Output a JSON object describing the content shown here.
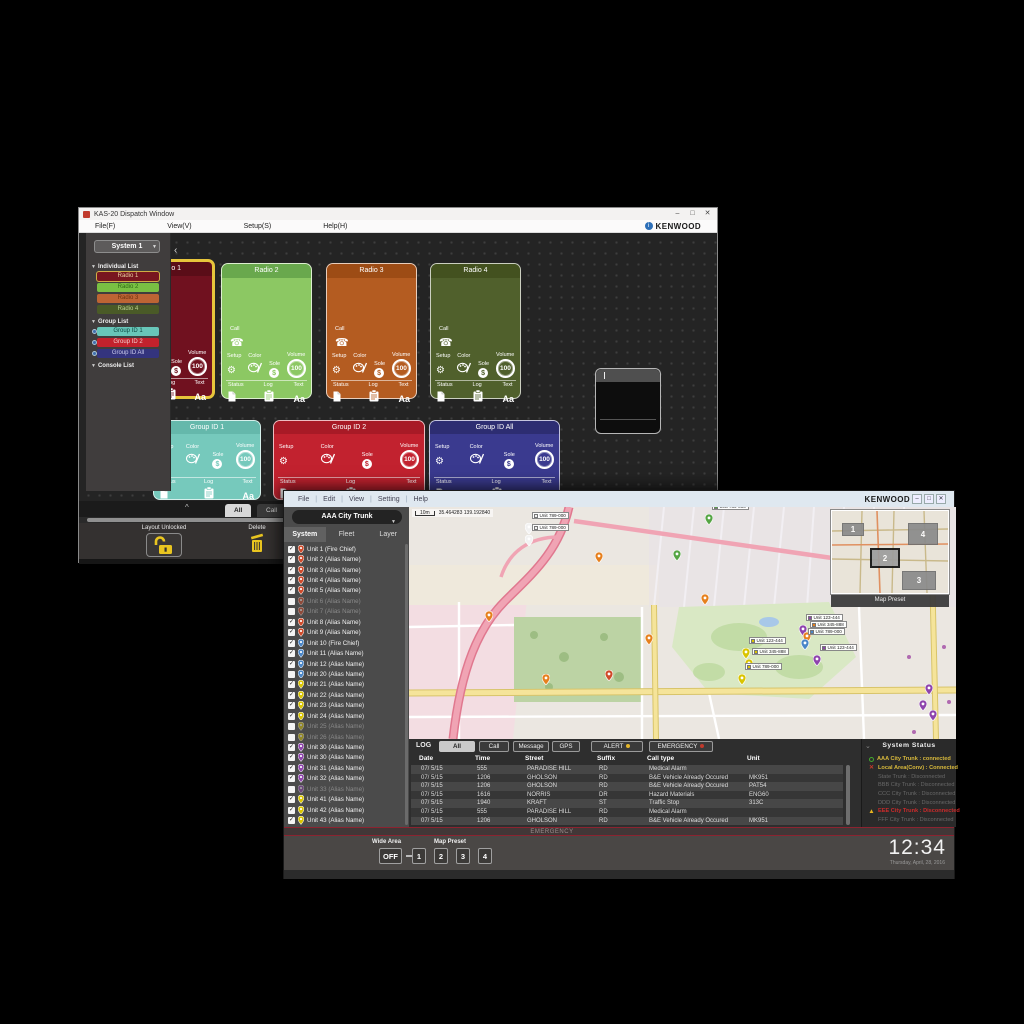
{
  "back_window": {
    "title": "KAS-20 Dispatch Window",
    "brand": "KENWOOD",
    "window_controls": [
      "–",
      "□",
      "✕"
    ],
    "menu_items": [
      "File(F)",
      "View(V)",
      "Setup(S)",
      "Help(H)"
    ],
    "system_selector": "System 1",
    "sidebar_sections": [
      {
        "label": "Individual List",
        "items": [
          {
            "label": "Radio 1",
            "color": "#78161f",
            "text_color": "#e8d0a0",
            "selected": true
          },
          {
            "label": "Radio 2",
            "color": "#79c043",
            "text_color": "#2e6b14"
          },
          {
            "label": "Radio 3",
            "color": "#bd6434",
            "text_color": "#6e3210"
          },
          {
            "label": "Radio 4",
            "color": "#4a5a27",
            "text_color": "#b9cf8e"
          }
        ]
      },
      {
        "label": "Group List",
        "items": [
          {
            "label": "Group ID 1",
            "color": "#68c6b9",
            "text_color": "#0e4a42",
            "group": true
          },
          {
            "label": "Group ID 2",
            "color": "#c2222d",
            "text_color": "#f2d0d0",
            "group": true
          },
          {
            "label": "Group ID All",
            "color": "#34347e",
            "text_color": "#ccccee",
            "group": true
          }
        ]
      },
      {
        "label": "Console List",
        "items": []
      }
    ],
    "tiles": [
      {
        "css": "tile-radio1",
        "name": "Radio 1",
        "type": "radio",
        "body": "#70111f",
        "header": "#5a0d18",
        "selected": true
      },
      {
        "css": "tile-radio2",
        "name": "Radio 2",
        "type": "radio",
        "body": "#8cc863",
        "header": "#69a84d"
      },
      {
        "css": "tile-radio3",
        "name": "Radio 3",
        "type": "radio",
        "body": "#b45c21",
        "header": "#9d4c15"
      },
      {
        "css": "tile-radio4",
        "name": "Radio 4",
        "type": "radio",
        "body": "#50602c",
        "header": "#43511f"
      },
      {
        "css": "tile-group1",
        "name": "Group ID 1",
        "type": "group",
        "body": "#76c9bc",
        "header": "#65b8ab"
      },
      {
        "css": "tile-group2",
        "name": "Group ID 2",
        "type": "group",
        "body": "#c2222f",
        "header": "#a81a26"
      },
      {
        "css": "tile-groupall",
        "name": "Group ID All",
        "type": "group",
        "body": "#3a3a8f",
        "header": "#2d2d72"
      },
      {
        "css": "tile-blank",
        "name": "",
        "type": "blank",
        "body": "#0d0d0d",
        "header": "#4f4f4f"
      }
    ],
    "tile_labels": {
      "call": "Call",
      "setup": "Setup",
      "color": "Color",
      "sole": "Sole",
      "volume": "Volume",
      "volume_value": "100",
      "status": "Status",
      "log": "Log",
      "text": "Text",
      "text_glyph": "Aa"
    },
    "dock": {
      "tabs": [
        {
          "label": "All",
          "selected": true
        },
        {
          "label": "Call",
          "selected": false
        }
      ],
      "layout_label": "Layout Unlocked",
      "delete_label": "Delete"
    }
  },
  "front_window": {
    "brand": "KENWOOD",
    "window_controls": [
      "–",
      "□",
      "✕"
    ],
    "menu_items": [
      "File",
      "Edit",
      "View",
      "Setting",
      "Help"
    ],
    "system_dropdown": "AAA City Trunk",
    "tabs": [
      {
        "label": "System",
        "selected": true
      },
      {
        "label": "Fleet",
        "selected": false
      },
      {
        "label": "Layer",
        "selected": false
      }
    ],
    "units": [
      {
        "label": "Unit 1 (Fire Chief)",
        "pin": "red",
        "checked": true,
        "dim": false
      },
      {
        "label": "Unit 2 (Alias Name)",
        "pin": "red",
        "checked": true,
        "dim": false
      },
      {
        "label": "Unit 3 (Alias Name)",
        "pin": "red",
        "checked": true,
        "dim": false
      },
      {
        "label": "Unit 4 (Alias Name)",
        "pin": "red",
        "checked": true,
        "dim": false
      },
      {
        "label": "Unit 5 (Alias Name)",
        "pin": "red",
        "checked": true,
        "dim": false
      },
      {
        "label": "Unit 6 (Alias Name)",
        "pin": "red",
        "checked": false,
        "dim": true
      },
      {
        "label": "Unit 7 (Alias Name)",
        "pin": "red",
        "checked": false,
        "dim": true
      },
      {
        "label": "Unit 8 (Alias Name)",
        "pin": "red",
        "checked": true,
        "dim": false
      },
      {
        "label": "Unit 9 (Alias Name)",
        "pin": "red",
        "checked": true,
        "dim": false
      },
      {
        "label": "Unit 10 (Fire Chief)",
        "pin": "blue",
        "checked": true,
        "dim": false
      },
      {
        "label": "Unit 11 (Alias Name)",
        "pin": "blue",
        "checked": true,
        "dim": false
      },
      {
        "label": "Unit 12 (Alias Name)",
        "pin": "blue",
        "checked": true,
        "dim": false
      },
      {
        "label": "Unit 20 (Alias Name)",
        "pin": "blue",
        "checked": false,
        "dim": false
      },
      {
        "label": "Unit 21 (Alias Name)",
        "pin": "yellow",
        "checked": true,
        "dim": false
      },
      {
        "label": "Unit 22 (Alias Name)",
        "pin": "yellow",
        "checked": true,
        "dim": false
      },
      {
        "label": "Unit 23 (Alias Name)",
        "pin": "yellow",
        "checked": true,
        "dim": false
      },
      {
        "label": "Unit 24 (Alias Name)",
        "pin": "yellow",
        "checked": true,
        "dim": false
      },
      {
        "label": "Unit 25 (Alias Name)",
        "pin": "yellow",
        "checked": false,
        "dim": true
      },
      {
        "label": "Unit 26 (Alias Name)",
        "pin": "yellow",
        "checked": false,
        "dim": true
      },
      {
        "label": "Unit 30 (Alias Name)",
        "pin": "purple",
        "checked": true,
        "dim": false
      },
      {
        "label": "Unit 30 (Alias Name)",
        "pin": "purple",
        "checked": true,
        "dim": false
      },
      {
        "label": "Unit 31 (Alias Name)",
        "pin": "purple",
        "checked": true,
        "dim": false
      },
      {
        "label": "Unit 32 (Alias Name)",
        "pin": "purple",
        "checked": true,
        "dim": false
      },
      {
        "label": "Unit 33 (Alias Name)",
        "pin": "purple",
        "checked": false,
        "dim": true
      },
      {
        "label": "Unit 41 (Alias Name)",
        "pin": "yellow",
        "checked": true,
        "dim": false
      },
      {
        "label": "Unit 42 (Alias Name)",
        "pin": "yellow",
        "checked": true,
        "dim": false
      },
      {
        "label": "Unit 43 (Alias Name)",
        "pin": "yellow",
        "checked": true,
        "dim": false
      }
    ],
    "map": {
      "scale_label": "10m",
      "coordinates": "35.464283   139.192840",
      "pin_colors": {
        "red": "#cf4a2a",
        "blue": "#4a86c8",
        "yellow": "#d9c400",
        "purple": "#8e44ad",
        "orange": "#e6801e",
        "green": "#55a544",
        "white": "#f2f2f2"
      },
      "markers": [
        {
          "x": 120,
          "y": 25,
          "color": "white",
          "label": "Unit 789-000"
        },
        {
          "x": 120,
          "y": 37,
          "color": "white",
          "label": "Unit 789-000"
        },
        {
          "x": 300,
          "y": 16,
          "color": "green",
          "label": "Unit 789-000"
        },
        {
          "x": 268,
          "y": 52,
          "color": "green"
        },
        {
          "x": 80,
          "y": 113,
          "color": "orange"
        },
        {
          "x": 137,
          "y": 176,
          "color": "orange"
        },
        {
          "x": 200,
          "y": 172,
          "color": "red"
        },
        {
          "x": 240,
          "y": 136,
          "color": "orange"
        },
        {
          "x": 296,
          "y": 96,
          "color": "orange"
        },
        {
          "x": 190,
          "y": 54,
          "color": "orange"
        },
        {
          "x": 337,
          "y": 150,
          "color": "yellow",
          "label": "Unit 123-444"
        },
        {
          "x": 340,
          "y": 161,
          "color": "yellow",
          "label": "Unit 345-888"
        },
        {
          "x": 333,
          "y": 176,
          "color": "yellow",
          "label": "Unit 789-000"
        },
        {
          "x": 394,
          "y": 127,
          "color": "purple",
          "label": "Unit 123-444"
        },
        {
          "x": 398,
          "y": 134,
          "color": "orange",
          "label": "Unit 345-888"
        },
        {
          "x": 396,
          "y": 141,
          "color": "blue",
          "label": "Unit 789-000"
        },
        {
          "x": 408,
          "y": 157,
          "color": "purple",
          "label": "Unit 123-444"
        },
        {
          "x": 520,
          "y": 186,
          "color": "purple"
        },
        {
          "x": 514,
          "y": 202,
          "color": "purple"
        },
        {
          "x": 524,
          "y": 212,
          "color": "purple"
        }
      ],
      "preset_overlay": {
        "label": "Map Preset",
        "items": [
          {
            "n": "1",
            "active": false
          },
          {
            "n": "2",
            "active": true
          },
          {
            "n": "3",
            "active": false
          },
          {
            "n": "4",
            "active": false
          }
        ]
      }
    },
    "log_panel": {
      "log_label": "LOG",
      "tabs": [
        {
          "label": "All",
          "selected": true
        },
        {
          "label": "Call",
          "selected": false
        },
        {
          "label": "Message",
          "selected": false
        },
        {
          "label": "GPS",
          "selected": false
        }
      ],
      "alert": {
        "label": "ALERT",
        "badge_color": "#e3b52a"
      },
      "emergency": {
        "label": "EMERGENCY",
        "badge_color": "#c0392b"
      },
      "columns": [
        "Date",
        "Time",
        "Street",
        "Suffix",
        "Call type",
        "Unit"
      ],
      "rows": [
        [
          "07/ 5/15",
          "555",
          "PARADISE HILL",
          "RD",
          "Medical Alarm",
          ""
        ],
        [
          "07/ 5/15",
          "1206",
          "GHOLSON",
          "RD",
          "B&E Vehicle Already Occured",
          "MK951"
        ],
        [
          "07/ 5/15",
          "1206",
          "GHOLSON",
          "RD",
          "B&E Vehicle Already Occured",
          "PAT54"
        ],
        [
          "07/ 5/15",
          "1616",
          "NORRIS",
          "DR",
          "Hazard Materials",
          "ENG60"
        ],
        [
          "07/ 5/15",
          "1940",
          "KRAFT",
          "ST",
          "Traffic Stop",
          "313C"
        ],
        [
          "07/ 5/15",
          "555",
          "PARADISE HILL",
          "RD",
          "Medical Alarm",
          ""
        ],
        [
          "07/ 5/15",
          "1206",
          "GHOLSON",
          "RD",
          "B&E Vehicle Already Occured",
          "MK951"
        ]
      ]
    },
    "system_status": {
      "title": "System Status",
      "rows": [
        {
          "icon": "ok",
          "text": "AAA City Trunk : connected",
          "style": "ok"
        },
        {
          "icon": "err",
          "text": "Local Area(Conv) : Connected",
          "style": "ok"
        },
        {
          "icon": "",
          "text": "State Trunk : Disconnected",
          "style": "dim"
        },
        {
          "icon": "",
          "text": "BBB City Trunk : Disconnected",
          "style": "dim"
        },
        {
          "icon": "",
          "text": "CCC City Trunk : Disconnected",
          "style": "dim"
        },
        {
          "icon": "",
          "text": "DDD City Trunk : Disconnected",
          "style": "dim"
        },
        {
          "icon": "warn",
          "text": "EEE City Trunk : Disconnected",
          "style": "alert"
        },
        {
          "icon": "",
          "text": "FFF City Trunk : Disconnected",
          "style": "dim"
        }
      ]
    },
    "emergency_bar_label": "EMERGENCY",
    "bottom_bar": {
      "wide_area_label": "Wide Area",
      "wide_area_value": "OFF",
      "map_preset_label": "Map Preset",
      "presets": [
        "1",
        "2",
        "3",
        "4"
      ],
      "clock": "12:34",
      "date": "Thursday, April, 28, 2016"
    }
  }
}
